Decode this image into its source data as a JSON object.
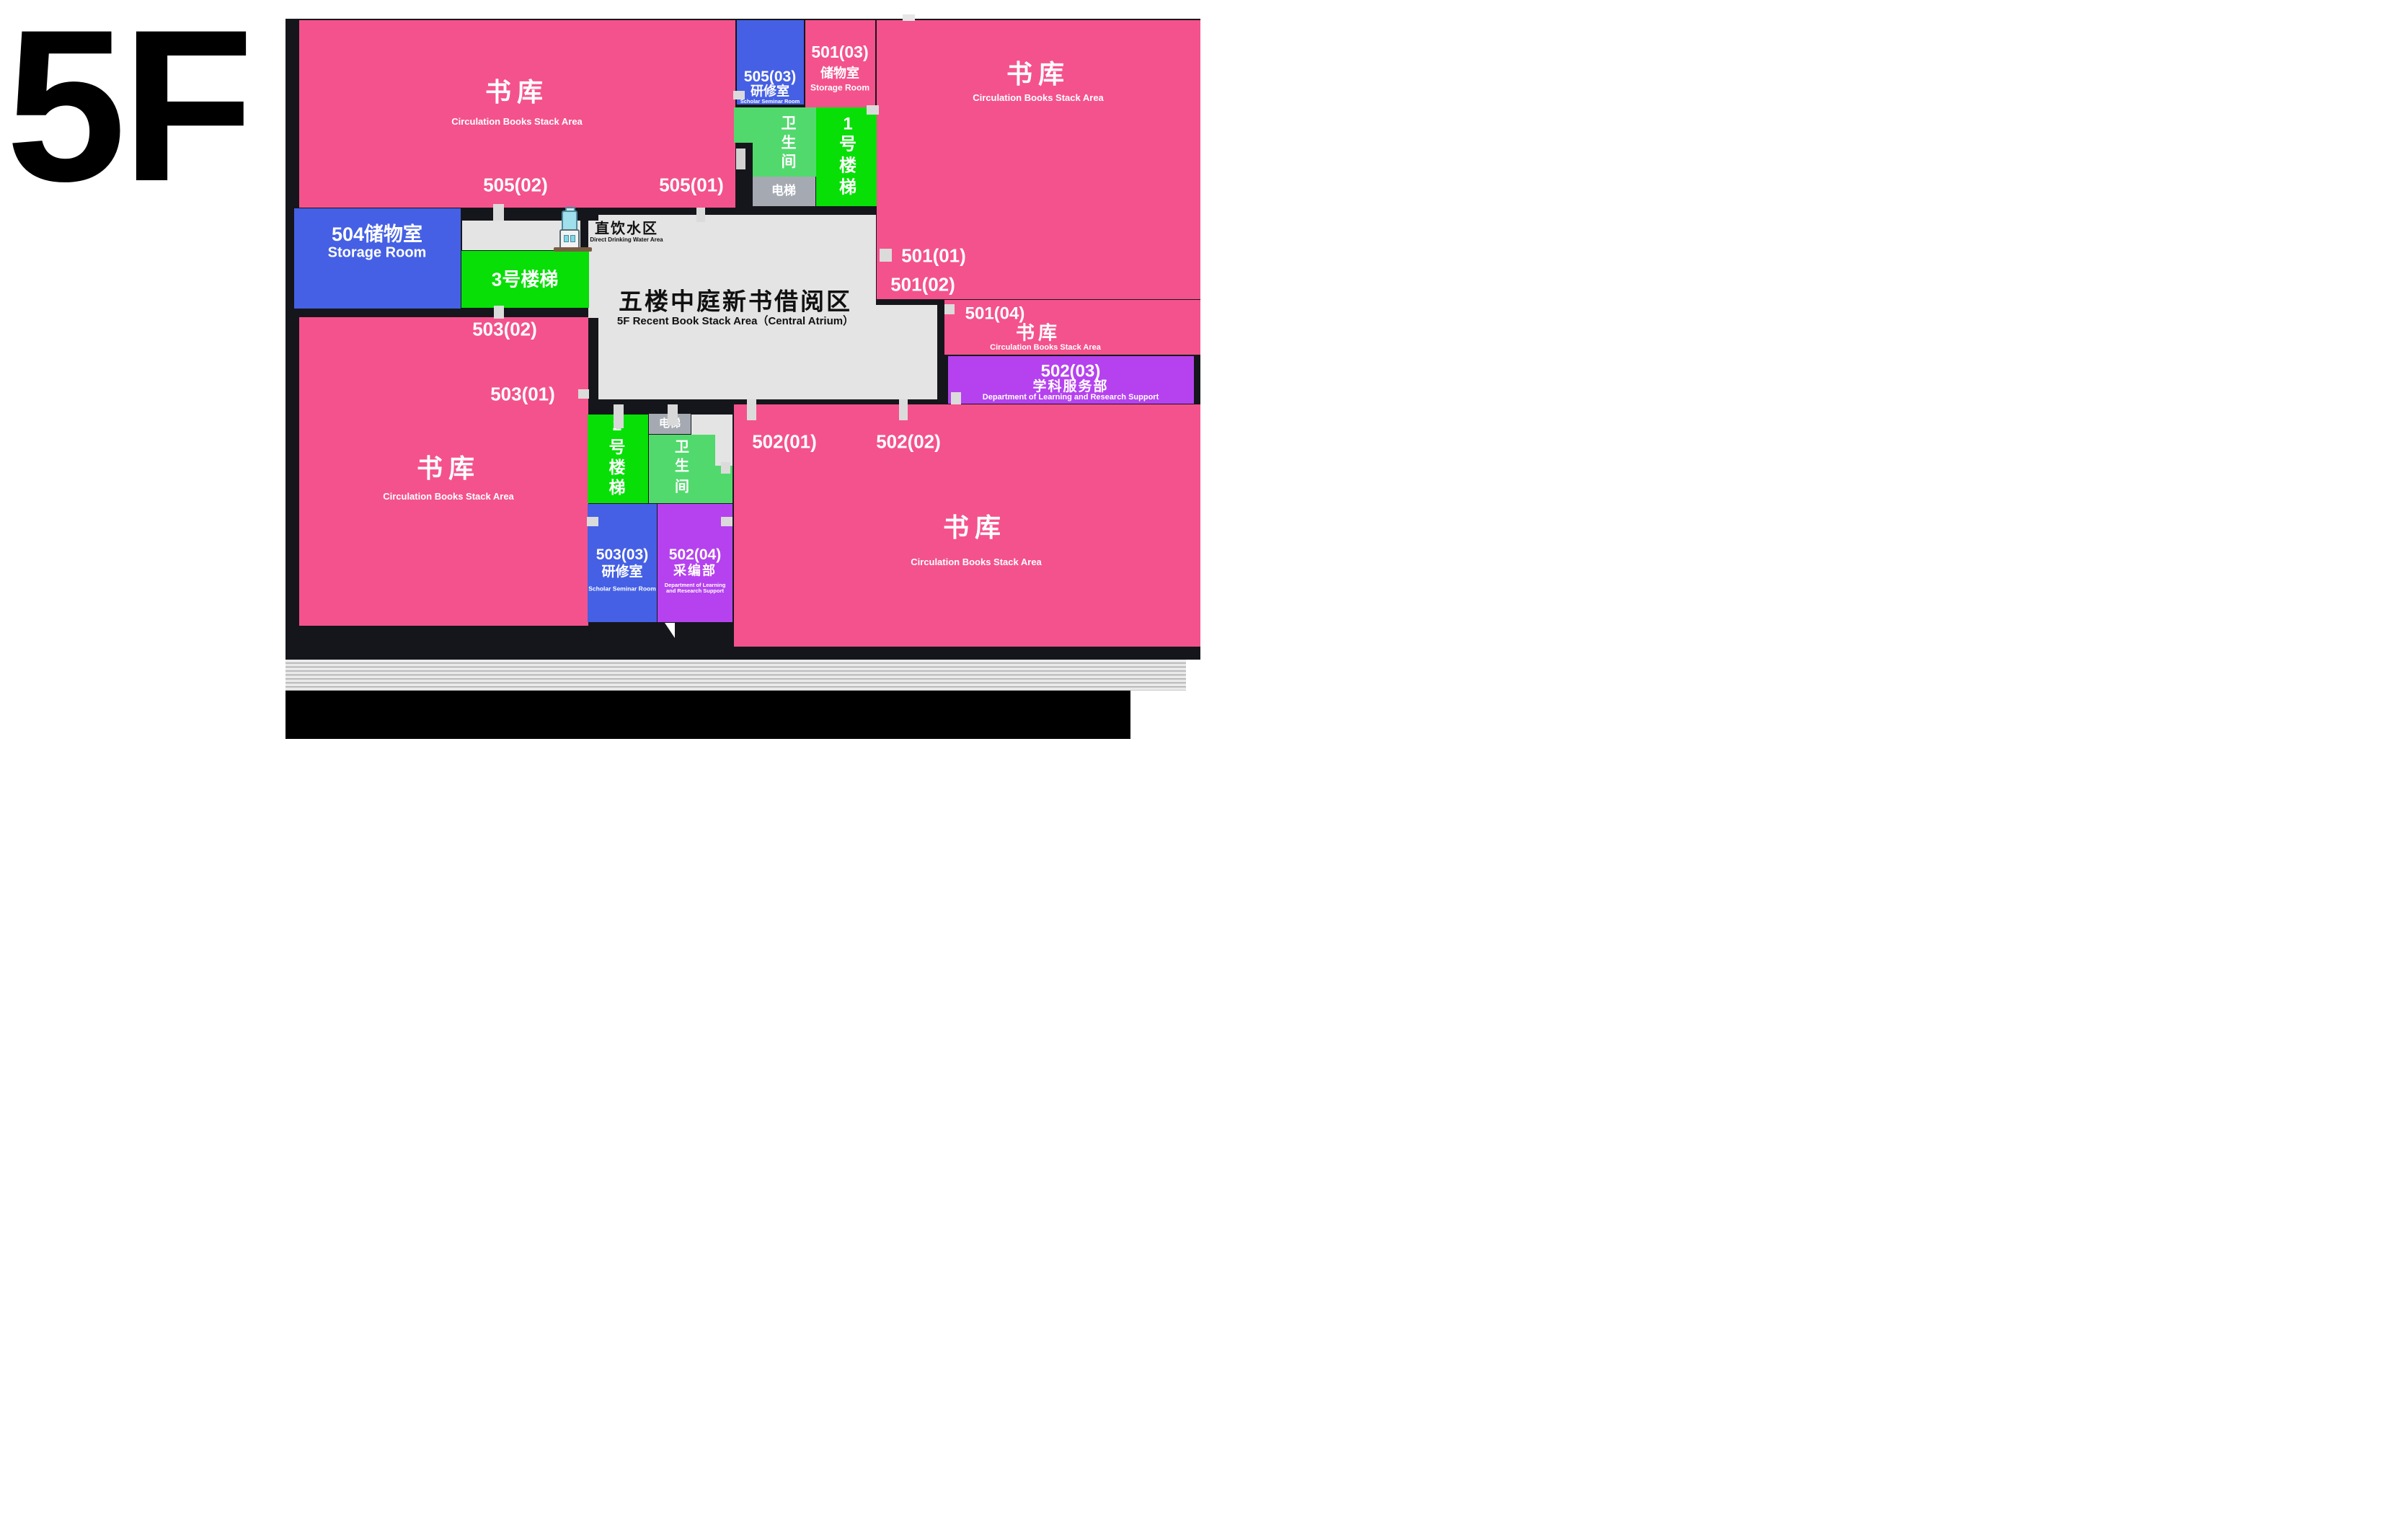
{
  "floor_label": "5F",
  "colors": {
    "pink": "#F4528C",
    "blue": "#4560E4",
    "green_stair": "#07DF07",
    "green_toilet": "#52D96D",
    "gray_elevator": "#A5AAB2",
    "purple": "#B542EE",
    "atrium_gray": "#E4E4E4",
    "wall": "#15161B"
  },
  "rooms": {
    "stack": {
      "cn": "书库",
      "en": "Circulation Books Stack Area"
    },
    "seminar_505": {
      "num": "505(03)",
      "cn": "研修室",
      "en": "Scholar Seminar Room"
    },
    "storage_501": {
      "num": "501(03)",
      "cn": "储物室",
      "en": "Storage Room"
    },
    "storage_504": {
      "cn": "504储物室",
      "en": "Storage Room"
    },
    "seminar_503": {
      "num": "503(03)",
      "cn": "研修室",
      "en": "Scholar Seminar Room"
    },
    "dept_502_03": {
      "num": "502(03)",
      "cn": "学科服务部",
      "en": "Department of Learning and Research Support"
    },
    "dept_502_04": {
      "num": "502(04)",
      "cn": "采编部",
      "en1": "Department of Learning",
      "en2": "and Research Support"
    },
    "toilet": {
      "chars": [
        "卫",
        "生",
        "间"
      ]
    },
    "elevator": {
      "label": "电梯"
    },
    "stair_1": {
      "chars": [
        "1",
        "号",
        "楼",
        "梯"
      ]
    },
    "stair_2": {
      "chars": [
        "2",
        "号",
        "楼",
        "梯"
      ]
    },
    "stair_3": {
      "label": "3号楼梯"
    }
  },
  "atrium": {
    "cn": "五楼中庭新书借阅区",
    "en": "5F Recent Book Stack Area（Central Atrium）"
  },
  "water": {
    "cn": "直饮水区",
    "en": "Direct Drinking Water Area"
  },
  "door_labels": {
    "d505_02": "505(02)",
    "d505_01": "505(01)",
    "d501_01": "501(01)",
    "d501_02": "501(02)",
    "d501_04": "501(04)",
    "d503_02": "503(02)",
    "d503_01": "503(01)",
    "d502_01": "502(01)",
    "d502_02": "502(02)"
  }
}
